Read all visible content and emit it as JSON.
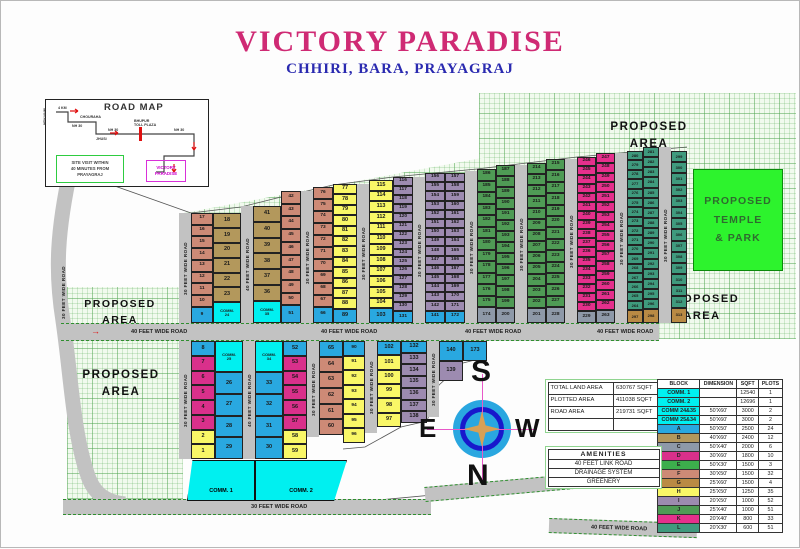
{
  "title": "VICTORY PARADISE",
  "subtitle": "CHHIRI, BARA, PRAYAGRAJ",
  "labels": {
    "proposed_area": "PROPOSED AREA",
    "temple": "PROPOSED\nTEMPLE\n& PARK"
  },
  "compass": {
    "top": "S",
    "bottom": "N",
    "left": "E",
    "right": "W"
  },
  "road_map": {
    "title": "ROAD MAP",
    "side_label": "NEW NAINI",
    "labels": [
      {
        "t": "4 KM",
        "x": 12,
        "y": 7
      },
      {
        "t": "CHOURAHA",
        "x": 34,
        "y": 16
      },
      {
        "t": "NH 30",
        "x": 26,
        "y": 25
      },
      {
        "t": "NH 30",
        "x": 62,
        "y": 29
      },
      {
        "t": "JHUSI",
        "x": 50,
        "y": 38
      },
      {
        "t": "BHUPUR\nTOLL PLAZA",
        "x": 88,
        "y": 20
      },
      {
        "t": "NH 30",
        "x": 128,
        "y": 29
      }
    ],
    "site_box": "SITE VISIT WITHIN\n40 MINUTES FROM\nPRAYAGRAJ",
    "dest_box": "VICTORY\nPARADISE"
  },
  "area_table": {
    "rows": [
      [
        "TOTAL LAND AREA",
        "630767 SQFT"
      ],
      [
        "PLOTTED AREA",
        "411038 SQFT"
      ],
      [
        "ROAD AREA",
        "219731 SQFT"
      ],
      [
        "",
        ""
      ]
    ]
  },
  "legend": {
    "headers": [
      "BLOCK",
      "DIMENSION",
      "SQFT",
      "PLOTS"
    ],
    "rows": [
      {
        "block": "COMM. 1",
        "color": "#00f0f0",
        "dimension": "",
        "sqft": "12540",
        "plots": "1"
      },
      {
        "block": "COMM. 2",
        "color": "#00f0f0",
        "dimension": "",
        "sqft": "12696",
        "plots": "1"
      },
      {
        "block": "COMM 24&35",
        "color": "#00f0f0",
        "dimension": "50'X60'",
        "sqft": "3000",
        "plots": "2"
      },
      {
        "block": "COMM 25&34",
        "color": "#00f0f0",
        "dimension": "50'X60'",
        "sqft": "3000",
        "plots": "2"
      },
      {
        "block": "A",
        "color": "#29a8e0",
        "dimension": "50'X50'",
        "sqft": "2500",
        "plots": "24"
      },
      {
        "block": "B",
        "color": "#b3985c",
        "dimension": "40'X60'",
        "sqft": "2400",
        "plots": "12"
      },
      {
        "block": "C",
        "color": "#8e99a8",
        "dimension": "50'X40'",
        "sqft": "2000",
        "plots": "6"
      },
      {
        "block": "D",
        "color": "#d9308b",
        "dimension": "30'X60'",
        "sqft": "1800",
        "plots": "10"
      },
      {
        "block": "E",
        "color": "#3cae4c",
        "dimension": "50'X30'",
        "sqft": "1500",
        "plots": "3"
      },
      {
        "block": "F",
        "color": "#cd8a76",
        "dimension": "30'X50'",
        "sqft": "1500",
        "plots": "32"
      },
      {
        "block": "G",
        "color": "#b98a44",
        "dimension": "25'X60'",
        "sqft": "1500",
        "plots": "4"
      },
      {
        "block": "H",
        "color": "#f9f767",
        "dimension": "25'X50'",
        "sqft": "1250",
        "plots": "35"
      },
      {
        "block": "I",
        "color": "#9d8bb0",
        "dimension": "20'X50'",
        "sqft": "1000",
        "plots": "52"
      },
      {
        "block": "J",
        "color": "#4f9b55",
        "dimension": "25'X40'",
        "sqft": "1000",
        "plots": "51"
      },
      {
        "block": "K",
        "color": "#e5308c",
        "dimension": "20'X40'",
        "sqft": "800",
        "plots": "33"
      },
      {
        "block": "L",
        "color": "#3f9a7d",
        "dimension": "20'X30'",
        "sqft": "600",
        "plots": "51"
      }
    ]
  },
  "amenities": {
    "title": "AMENITIES",
    "items": [
      "40 FEET LINK ROAD",
      "DRAINAGE SYSTEM",
      "GREENERY"
    ]
  },
  "palette": {
    "A": "#29a8e0",
    "B": "#b3985c",
    "C": "#8e99a8",
    "D": "#d9308b",
    "E": "#3cae4c",
    "F": "#cd8a76",
    "G": "#b98a44",
    "H": "#f9f767",
    "I": "#9d8bb0",
    "J": "#4f9b55",
    "K": "#e5308c",
    "L": "#3f9a7d",
    "M": "#00f0f0"
  },
  "map": {
    "left_road_label": "30 FEET WIDE ROAD",
    "top_columns": [
      {
        "road": true,
        "x": 178,
        "y": 212,
        "w": 12,
        "label": "30 FEET WIDE ROAD"
      },
      {
        "x": 190,
        "y": 212,
        "w": 22,
        "cells": [
          "F:17",
          "F:16",
          "F:15",
          "F:14",
          "F:13",
          "F:12",
          "F:11",
          "F:10",
          "A:9"
        ]
      },
      {
        "x": 212,
        "y": 212,
        "w": 28,
        "cells": [
          "B:18",
          "B:19",
          "B:20",
          "B:21",
          "B:22",
          "B:23",
          "M:COMM.\n24"
        ]
      },
      {
        "road": true,
        "x": 240,
        "y": 205,
        "w": 12,
        "label": "40 FEET WIDE ROAD"
      },
      {
        "x": 252,
        "y": 205,
        "w": 28,
        "cells": [
          "B:41",
          "B:40",
          "B:39",
          "B:38",
          "B:37",
          "B:36",
          "M:COMM.\n35"
        ]
      },
      {
        "x": 280,
        "y": 190,
        "w": 20,
        "cells": [
          "F:42",
          "F:43",
          "F:44",
          "F:45",
          "F:46",
          "F:47",
          "F:48",
          "F:49",
          "F:50",
          "A:51"
        ]
      },
      {
        "road": true,
        "x": 300,
        "y": 190,
        "w": 12,
        "label": "30 FEET WIDE ROAD"
      },
      {
        "x": 312,
        "y": 186,
        "w": 20,
        "cells": [
          "F:76",
          "F:75",
          "F:74",
          "F:73",
          "F:72",
          "F:71",
          "F:70",
          "F:69",
          "F:68",
          "F:67",
          "A:66"
        ]
      },
      {
        "x": 332,
        "y": 183,
        "w": 24,
        "cells": [
          "H:77",
          "H:78",
          "H:79",
          "H:80",
          "H:81",
          "H:82",
          "H:83",
          "H:84",
          "H:85",
          "H:86",
          "H:87",
          "H:88",
          "A:89"
        ]
      },
      {
        "road": true,
        "x": 356,
        "y": 183,
        "w": 12,
        "label": "30 FEET WIDE ROAD"
      },
      {
        "x": 368,
        "y": 179,
        "w": 24,
        "cells": [
          "H:115",
          "H:114",
          "H:113",
          "H:112",
          "H:111",
          "H:110",
          "H:109",
          "H:108",
          "H:107",
          "H:106",
          "H:105",
          "H:104",
          "A:103"
        ]
      },
      {
        "x": 392,
        "y": 176,
        "w": 20,
        "cells": [
          "I:116",
          "I:117",
          "I:118",
          "I:119",
          "I:120",
          "I:121",
          "I:122",
          "I:123",
          "I:124",
          "I:125",
          "I:126",
          "I:127",
          "I:128",
          "I:129",
          "I:130",
          "A:131"
        ]
      },
      {
        "road": true,
        "x": 412,
        "y": 176,
        "w": 12,
        "label": "30 FEET WIDE ROAD"
      },
      {
        "x": 424,
        "y": 172,
        "w": 20,
        "cells": [
          "I:156",
          "I:155",
          "I:154",
          "I:153",
          "I:152",
          "I:151",
          "I:150",
          "I:149",
          "I:148",
          "I:147",
          "I:146",
          "I:145",
          "I:144",
          "I:143",
          "I:142",
          "A:141"
        ]
      },
      {
        "x": 444,
        "y": 172,
        "w": 20,
        "cells": [
          "I:157",
          "I:158",
          "I:159",
          "I:160",
          "I:161",
          "I:162",
          "I:163",
          "I:164",
          "I:165",
          "I:166",
          "I:167",
          "I:168",
          "I:169",
          "I:170",
          "I:171",
          "A:172"
        ]
      },
      {
        "road": true,
        "x": 464,
        "y": 170,
        "w": 12,
        "label": "30 FEET WIDE ROAD"
      },
      {
        "x": 476,
        "y": 168,
        "w": 19,
        "cells": [
          "J:186",
          "J:185",
          "J:184",
          "J:183",
          "J:182",
          "J:181",
          "J:180",
          "J:179",
          "J:178",
          "J:177",
          "J:176",
          "J:175",
          "C:174"
        ]
      },
      {
        "x": 495,
        "y": 164,
        "w": 19,
        "cells": [
          "J:187",
          "J:188",
          "J:189",
          "J:190",
          "J:191",
          "J:192",
          "J:193",
          "J:194",
          "J:195",
          "J:196",
          "J:197",
          "J:198",
          "J:199",
          "C:200"
        ]
      },
      {
        "road": true,
        "x": 514,
        "y": 164,
        "w": 12,
        "label": "30 FEET WIDE ROAD"
      },
      {
        "x": 526,
        "y": 162,
        "w": 19,
        "cells": [
          "J:214",
          "J:213",
          "J:212",
          "J:211",
          "J:210",
          "J:209",
          "J:208",
          "J:207",
          "J:206",
          "J:205",
          "J:204",
          "J:203",
          "J:202",
          "C:201"
        ]
      },
      {
        "x": 545,
        "y": 158,
        "w": 19,
        "cells": [
          "J:215",
          "J:216",
          "J:217",
          "J:218",
          "J:219",
          "J:220",
          "J:221",
          "J:222",
          "J:223",
          "J:224",
          "J:225",
          "J:226",
          "J:227",
          "C:228"
        ]
      },
      {
        "road": true,
        "x": 564,
        "y": 158,
        "w": 12,
        "label": "30 FEET WIDE ROAD"
      },
      {
        "x": 576,
        "y": 156,
        "w": 19,
        "cells": [
          "K:246",
          "K:245",
          "K:244",
          "K:243",
          "K:242",
          "K:241",
          "K:240",
          "K:239",
          "K:238",
          "K:237",
          "K:236",
          "K:235",
          "K:234",
          "K:233",
          "K:232",
          "K:231",
          "K:230",
          "C:229"
        ]
      },
      {
        "x": 595,
        "y": 152,
        "w": 19,
        "cells": [
          "K:247",
          "K:248",
          "K:249",
          "K:250",
          "K:251",
          "K:252",
          "K:253",
          "K:254",
          "K:255",
          "K:256",
          "K:257",
          "K:258",
          "K:259",
          "K:260",
          "K:261",
          "K:262",
          "C:263"
        ]
      },
      {
        "road": true,
        "x": 614,
        "y": 152,
        "w": 12,
        "label": "30 FEET WIDE ROAD"
      },
      {
        "x": 626,
        "y": 150,
        "w": 16,
        "cells": [
          "L:280",
          "L:279",
          "L:278",
          "L:277",
          "L:276",
          "L:275",
          "L:274",
          "L:273",
          "L:272",
          "L:271",
          "L:270",
          "L:269",
          "L:268",
          "L:267",
          "L:266",
          "L:265",
          "L:264",
          "G:297"
        ]
      },
      {
        "x": 642,
        "y": 146,
        "w": 16,
        "cells": [
          "L:281",
          "L:282",
          "L:283",
          "L:284",
          "L:285",
          "L:286",
          "L:287",
          "L:288",
          "L:289",
          "L:290",
          "L:291",
          "L:292",
          "L:293",
          "L:294",
          "L:295",
          "L:296",
          "G:298"
        ]
      },
      {
        "road": true,
        "x": 658,
        "y": 146,
        "w": 12,
        "label": "30 FEET WIDE ROAD"
      },
      {
        "x": 670,
        "y": 150,
        "w": 16,
        "cells": [
          "L:299",
          "L:300",
          "L:301",
          "L:302",
          "L:303",
          "L:304",
          "L:305",
          "L:306",
          "L:307",
          "L:308",
          "L:309",
          "L:310",
          "L:311",
          "L:312",
          "G:313"
        ]
      }
    ],
    "bottom_columns": [
      {
        "road": true,
        "x": 178,
        "y": 340,
        "w": 12,
        "h": 118,
        "label": "30 FEET WIDE ROAD"
      },
      {
        "x": 190,
        "y": 340,
        "w": 24,
        "h": 118,
        "cells": [
          "A:8",
          "D:7",
          "D:6",
          "D:5",
          "D:4",
          "D:3",
          "H:2",
          "H:1"
        ]
      },
      {
        "x": 214,
        "y": 340,
        "w": 28,
        "h": 118,
        "cells": [
          "M:COMM.\n25",
          "A:26",
          "A:27",
          "A:28",
          "A:29"
        ]
      },
      {
        "road": true,
        "x": 242,
        "y": 340,
        "w": 12,
        "h": 118,
        "label": "40 FEET WIDE ROAD"
      },
      {
        "x": 254,
        "y": 340,
        "w": 28,
        "h": 118,
        "cells": [
          "M:COMM.\n34",
          "A:33",
          "A:32",
          "A:31",
          "A:30"
        ]
      },
      {
        "x": 282,
        "y": 340,
        "w": 24,
        "h": 118,
        "cells": [
          "A:52",
          "D:53",
          "D:54",
          "D:55",
          "D:56",
          "D:57",
          "H:58",
          "H:59"
        ]
      },
      {
        "road": true,
        "x": 306,
        "y": 340,
        "w": 12,
        "h": 96,
        "label": "30 FEET WIDE ROAD"
      },
      {
        "x": 318,
        "y": 340,
        "w": 24,
        "h": 94,
        "cells": [
          "A:65",
          "F:64",
          "F:63",
          "F:62",
          "F:61",
          "F:60"
        ]
      },
      {
        "x": 342,
        "y": 340,
        "w": 22,
        "h": 102,
        "cells": [
          "A:90",
          "H:91",
          "H:92",
          "H:93",
          "H:94",
          "H:95",
          "H:96"
        ]
      },
      {
        "road": true,
        "x": 364,
        "y": 340,
        "w": 12,
        "h": 92,
        "label": "30 FEET WIDE ROAD"
      },
      {
        "x": 376,
        "y": 340,
        "w": 24,
        "h": 86,
        "cells": [
          "A:102",
          "H:101",
          "H:100",
          "H:99",
          "H:98",
          "H:97"
        ]
      },
      {
        "x": 400,
        "y": 340,
        "w": 26,
        "h": 82,
        "cells": [
          "A:132",
          "I:133",
          "I:134",
          "I:135",
          "I:136",
          "I:137",
          "I:138"
        ]
      },
      {
        "road": true,
        "x": 426,
        "y": 340,
        "w": 12,
        "h": 76,
        "label": "30 FEET WIDE ROAD"
      },
      {
        "x": 438,
        "y": 340,
        "w": 24,
        "h": 40,
        "cells": [
          "A:140",
          "I:139"
        ]
      },
      {
        "x": 462,
        "y": 340,
        "w": 24,
        "h": 20,
        "cells": [
          "A:173"
        ]
      }
    ],
    "comm_blocks": [
      {
        "x": 186,
        "y": 459,
        "w": 68,
        "h": 41,
        "label": "COMM. 1",
        "clip": "polygon(8% 0,100% 0,100% 100%,0 100%)"
      },
      {
        "x": 254,
        "y": 459,
        "w": 92,
        "h": 41,
        "label": "COMM. 2",
        "clip": "polygon(0 0,100% 0,86% 100%,0 100%)"
      }
    ],
    "hroads": [
      {
        "x": 60,
        "y": 322,
        "w": 598,
        "h": 16,
        "arrow": true,
        "labels": [
          {
            "t": "40 FEET WIDE ROAD",
            "x": 70
          },
          {
            "t": "40 FEET WIDE ROAD",
            "x": 260
          },
          {
            "t": "40 FEET WIDE ROAD",
            "x": 404
          },
          {
            "t": "40 FEET WIDE ROAD",
            "x": 536
          }
        ]
      },
      {
        "x": 62,
        "y": 498,
        "w": 368,
        "h": 14,
        "labels": [
          {
            "t": "30 FEET WIDE ROAD",
            "x": 188
          }
        ]
      },
      {
        "x": 424,
        "y": 486,
        "w": 150,
        "h": 13,
        "rot": -5,
        "labels": []
      },
      {
        "x": 548,
        "y": 517,
        "w": 148,
        "h": 13,
        "rot": 2,
        "labels": [
          {
            "t": "40 FEET WIDE ROAD",
            "x": 42
          }
        ]
      }
    ]
  }
}
